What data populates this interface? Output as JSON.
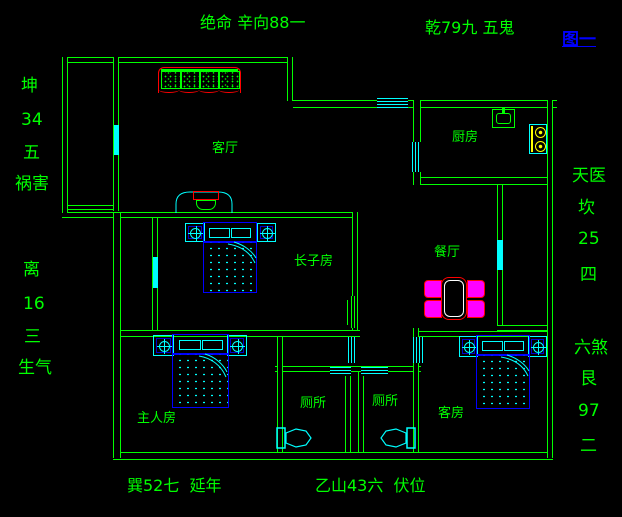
{
  "figure_label": "图一",
  "compass_annotations": {
    "top_left": "绝命 辛向88一",
    "top_right": "乾79九 五鬼",
    "left_upper": [
      "坤",
      "34",
      "五",
      "祸害"
    ],
    "left_lower": [
      "离",
      "16",
      "三",
      "生气"
    ],
    "right_upper": [
      "天医",
      "坎",
      "25",
      "四"
    ],
    "right_lower": [
      "六煞",
      "艮",
      "97",
      "二"
    ],
    "bottom_left": "巽52七  延年",
    "bottom_right": "乙山43六  伏位"
  },
  "rooms": {
    "living_room": "客厅",
    "kitchen": "厨房",
    "eldest_son_room": "长子房",
    "dining_room": "餐厅",
    "master_bedroom": "主人房",
    "toilet_left": "厕所",
    "toilet_right": "厕所",
    "guest_room": "客房"
  },
  "colors": {
    "background": "#000000",
    "wall": "#00ff00",
    "text": "#00ff00",
    "figure_label": "#0000ff",
    "fixture": "#00ffff",
    "furniture_accent": "#0000ff",
    "sofa_outline": "#ff0000",
    "chair_fill": "#ff00ff",
    "table_inner": "#ffffff",
    "stove_burner": "#ffff00"
  }
}
